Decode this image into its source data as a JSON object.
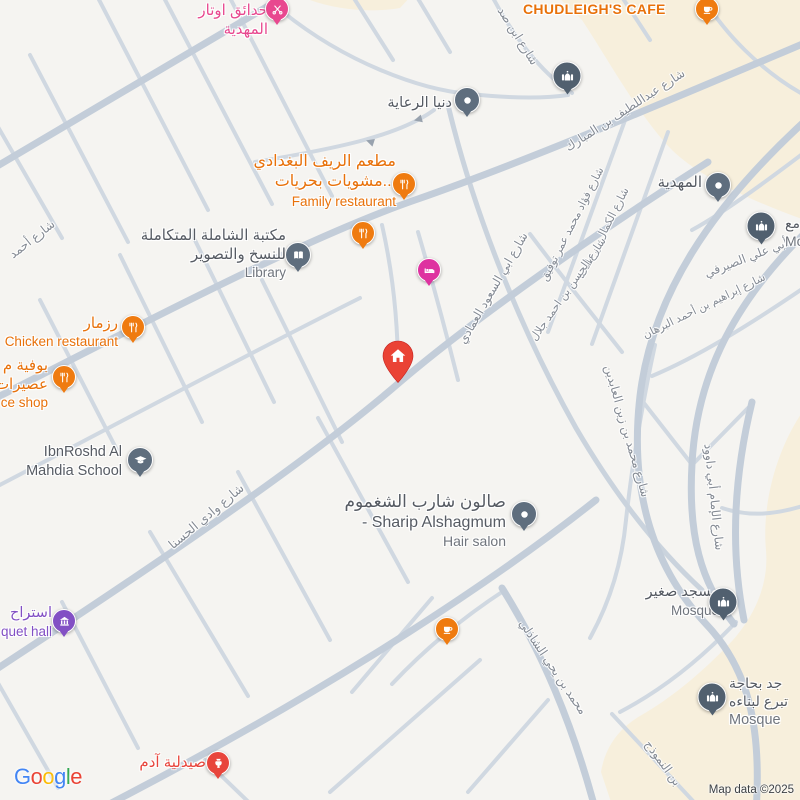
{
  "map": {
    "attribution": "Map data ©2025",
    "logo_letters": [
      "G",
      "o",
      "o",
      "g",
      "l",
      "e"
    ],
    "logo_colors": [
      "#4285F4",
      "#EA4335",
      "#FBBC05",
      "#4285F4",
      "#34A853",
      "#EA4335"
    ],
    "colors": {
      "land": "#f5f4f1",
      "commercial_area": "#f7efdc",
      "road_major": "#c3cdd9",
      "road_minor": "#d0d8e1",
      "poi_orange": "#E8710A",
      "poi_pink": "#E8488F",
      "poi_magenta": "#DE32A0",
      "poi_purple": "#8250C4",
      "poi_red": "#E8453C",
      "poi_gray": "#5F6E7E",
      "mosque_gray": "#51606F",
      "home_marker_red": "#EA4335",
      "label_dark": "#565B63",
      "label_gray": "#70757D",
      "street_label_gray": "#858B94"
    },
    "pois": {
      "otar": {
        "l1": "حدائق اوتار",
        "l2": "المهدية"
      },
      "chudleigh": {
        "name": "CHUDLEIGH'S CAFE"
      },
      "donia": {
        "name": "دنيا الرعاية"
      },
      "family": {
        "l1": "مطعم الريف البغدادي",
        "l2": "مشويات بحريات...",
        "en": "Family restaurant"
      },
      "library": {
        "l1": "مكتبة الشاملة المتكاملة",
        "l2": "للنسخ والتصوير",
        "en": "Library"
      },
      "rizmar": {
        "l1": "رزمار",
        "en": "Chicken restaurant"
      },
      "juice": {
        "l1": "بوفية م",
        "l2": "عصيرات",
        "en": "ce shop"
      },
      "school": {
        "l1": "IbnRoshd Al",
        "l2": "Mahdia School"
      },
      "mahdia": {
        "name": "المهدية"
      },
      "mosque_right": {
        "l1": "مع",
        "en": "Mo"
      },
      "hair": {
        "l1": "صالون شارب الشغموم",
        "l2": "- Sharip Alshagmum",
        "en": "Hair salon"
      },
      "mosque_small": {
        "l1": "مسجد صغير",
        "en": "Mosque"
      },
      "mosque_build": {
        "l1": "جد بحاجة",
        "l2": "تبرع لبناءه",
        "en": "Mosque"
      },
      "banquet": {
        "l1": "استراح",
        "en": "quet hall"
      },
      "pharmacy": {
        "name": "صيدلية آدم"
      }
    },
    "streets": [
      "شارع ابن صد",
      "شارع عبداللطيف بن المبارك",
      "شارع أحمد",
      "شارع فؤاد محمد عمر توفيق",
      "شارع الكمال بن طلحة",
      "شارع الحسن بن احمد جلال",
      "شارع محمد بن زين العابدين",
      "شارع ابي السعود العمادي",
      "شارع وادي الحسنا",
      "محمد بن يحي الشاذلي",
      "بن النموذج",
      "شارع الإمام أبي داوود",
      "أبي علي الصيرفي",
      "شارع إبراهيم بن أحمد البرهان"
    ],
    "pins": [
      {
        "icon": "scissors-icon",
        "color": "#E8488F",
        "poi": "otar"
      },
      {
        "icon": "coffee-icon",
        "color": "#EF7B10",
        "poi": "chudleigh"
      },
      {
        "icon": "dot-icon",
        "color": "#5F6E7E",
        "poi": "donia"
      },
      {
        "icon": "mosque-icon",
        "color": "#51606F",
        "poi": "mosque-top"
      },
      {
        "icon": "restaurant-icon",
        "color": "#EF7B10",
        "poi": "family"
      },
      {
        "icon": "restaurant-icon",
        "color": "#EF7B10",
        "poi": "restaurant-2"
      },
      {
        "icon": "bed-icon",
        "color": "#DE32A0",
        "poi": "hotel"
      },
      {
        "icon": "book-icon",
        "color": "#5F6E7E",
        "poi": "library"
      },
      {
        "icon": "restaurant-icon",
        "color": "#EF7B10",
        "poi": "rizmar"
      },
      {
        "icon": "restaurant-icon",
        "color": "#EF7B10",
        "poi": "juice"
      },
      {
        "icon": "school-icon",
        "color": "#5F6E7E",
        "poi": "school"
      },
      {
        "icon": "dot-icon",
        "color": "#5F6E7E",
        "poi": "mahdia"
      },
      {
        "icon": "mosque-icon",
        "color": "#51606F",
        "poi": "mosque_right"
      },
      {
        "icon": "dot-icon",
        "color": "#5F6E7E",
        "poi": "hair"
      },
      {
        "icon": "coffee-icon",
        "color": "#EF7B10",
        "poi": "coffee-shop"
      },
      {
        "icon": "mosque-icon",
        "color": "#51606F",
        "poi": "mosque_small"
      },
      {
        "icon": "mosque-icon",
        "color": "#51606F",
        "poi": "mosque_build"
      },
      {
        "icon": "building-icon",
        "color": "#8250C4",
        "poi": "banquet"
      },
      {
        "icon": "pharmacy-icon",
        "color": "#E8453C",
        "poi": "pharmacy"
      },
      {
        "icon": "home-icon",
        "color": "#EA4335",
        "poi": "home-marker"
      }
    ]
  }
}
